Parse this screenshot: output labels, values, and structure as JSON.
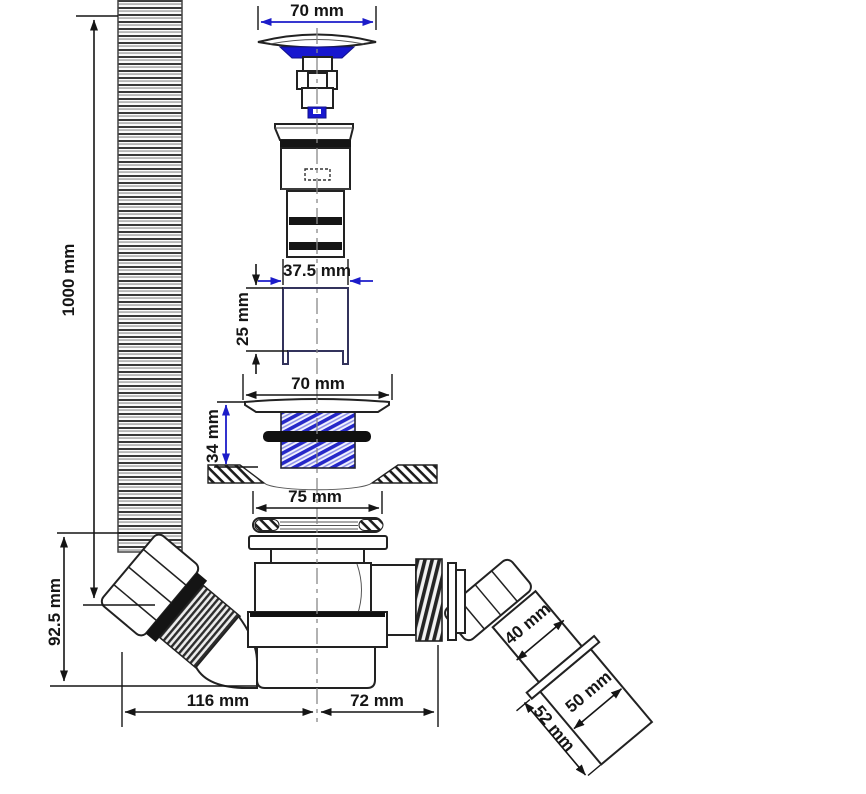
{
  "diagram": {
    "dimensions": {
      "plug_diameter": "70 mm",
      "hose_length": "1000 mm",
      "body_tail_width": "37.5 mm",
      "adjuster_height": "25 mm",
      "flange_diameter": "70 mm",
      "flange_height": "34 mm",
      "seal_diameter": "75 mm",
      "inlet_height": "92.5 mm",
      "base_width_left": "116 mm",
      "base_width_right": "72 mm",
      "outlet_bore": "40 mm",
      "outlet_pipe_diameter": "50 mm",
      "outlet_pipe_length": "52 mm"
    },
    "colors": {
      "accent_blue": "#1c1cc9",
      "line_dark": "#151515"
    }
  }
}
